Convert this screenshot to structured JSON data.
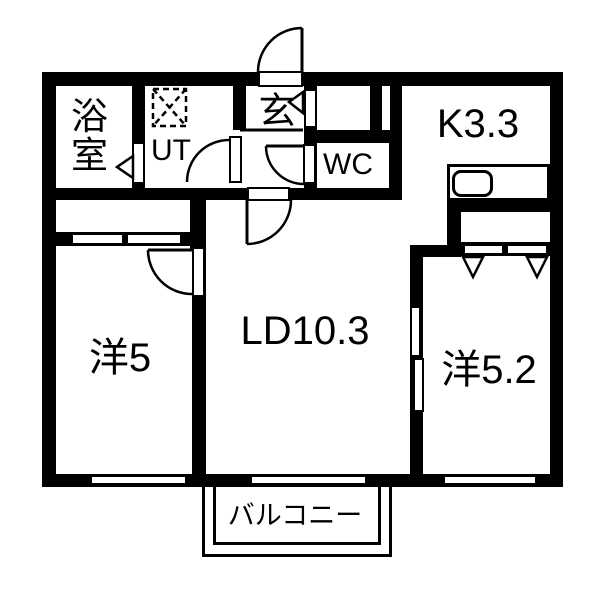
{
  "plan": {
    "title": "1LDK apartment floor plan",
    "colors": {
      "wall": "#000000",
      "floor": "#ffffff"
    },
    "rooms": {
      "bathroom": {
        "label": "浴室"
      },
      "utility": {
        "label": "UT"
      },
      "entrance": {
        "label": "玄"
      },
      "toilet": {
        "label": "WC"
      },
      "kitchen": {
        "label": "K3.3"
      },
      "living_dining": {
        "label": "LD10.3"
      },
      "western_room_5": {
        "label": "洋5"
      },
      "western_room_52": {
        "label": "洋5.2"
      },
      "balcony": {
        "label": "バルコニー"
      }
    }
  }
}
